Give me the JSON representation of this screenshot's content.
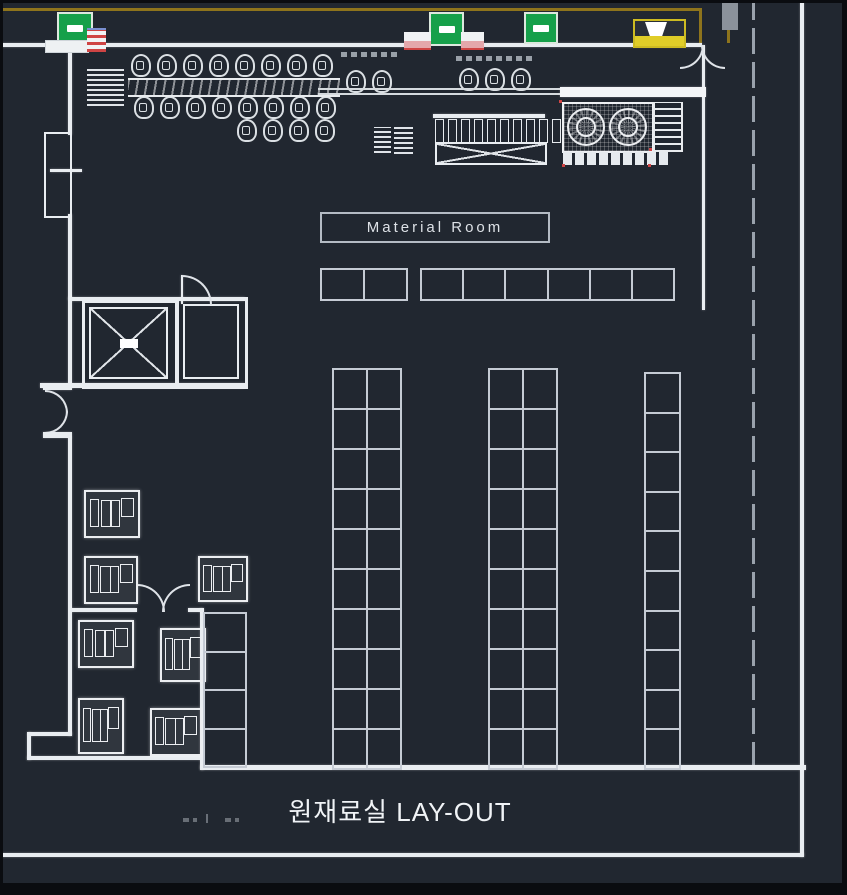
{
  "drawing": {
    "title": "원재료실 LAY-OUT",
    "room_label": "Material Room"
  },
  "colors": {
    "background": "#212730",
    "wall_white": "#e9edf1",
    "rack_line_gray": "#c5cbd4",
    "gold_reference_line": "#8e741c",
    "exit_sign_green": "#16a04a",
    "door_marker_pink": "#e4a7ab",
    "door_marker_red": "#cf4444",
    "light_fixture_yellow": "#e0cd28",
    "title_text": "#f0f3f6"
  },
  "storage": {
    "bin_row_left": {
      "rows": 1,
      "cols": 2,
      "cell_name": "storage-bin"
    },
    "bin_row_right": {
      "rows": 1,
      "cols": 6,
      "cell_name": "storage-bin"
    },
    "rack_left": {
      "rows": 10,
      "cols": 2,
      "cell_name": "rack-cell"
    },
    "rack_middle": {
      "rows": 10,
      "cols": 2,
      "cell_name": "rack-cell"
    },
    "rack_right": {
      "rows": 10,
      "cols": 1,
      "cell_name": "rack-cell"
    },
    "side_column": {
      "rows": 4,
      "cols": 1,
      "cell_name": "rack-cell"
    }
  },
  "equipment": {
    "workstations_top": {
      "count": 8,
      "glyph": "chair",
      "name": "workstation-icon"
    },
    "workstations_bottom": {
      "count": 8,
      "glyph": "chair",
      "name": "workstation-icon"
    },
    "workstations_lower": {
      "count": 4,
      "glyph": "chair",
      "name": "workstation-icon"
    },
    "station_pair": {
      "count": 2,
      "glyph": "chair",
      "name": "workstation-icon"
    },
    "station_trio": {
      "count": 3,
      "glyph": "chair",
      "name": "workstation-icon"
    },
    "comb_teeth": {
      "count": 10,
      "glyph": "tooth",
      "name": "machine-tooth-icon"
    },
    "comb_feet": {
      "count": 9,
      "glyph": "foot",
      "name": "machine-foot-icon"
    }
  }
}
